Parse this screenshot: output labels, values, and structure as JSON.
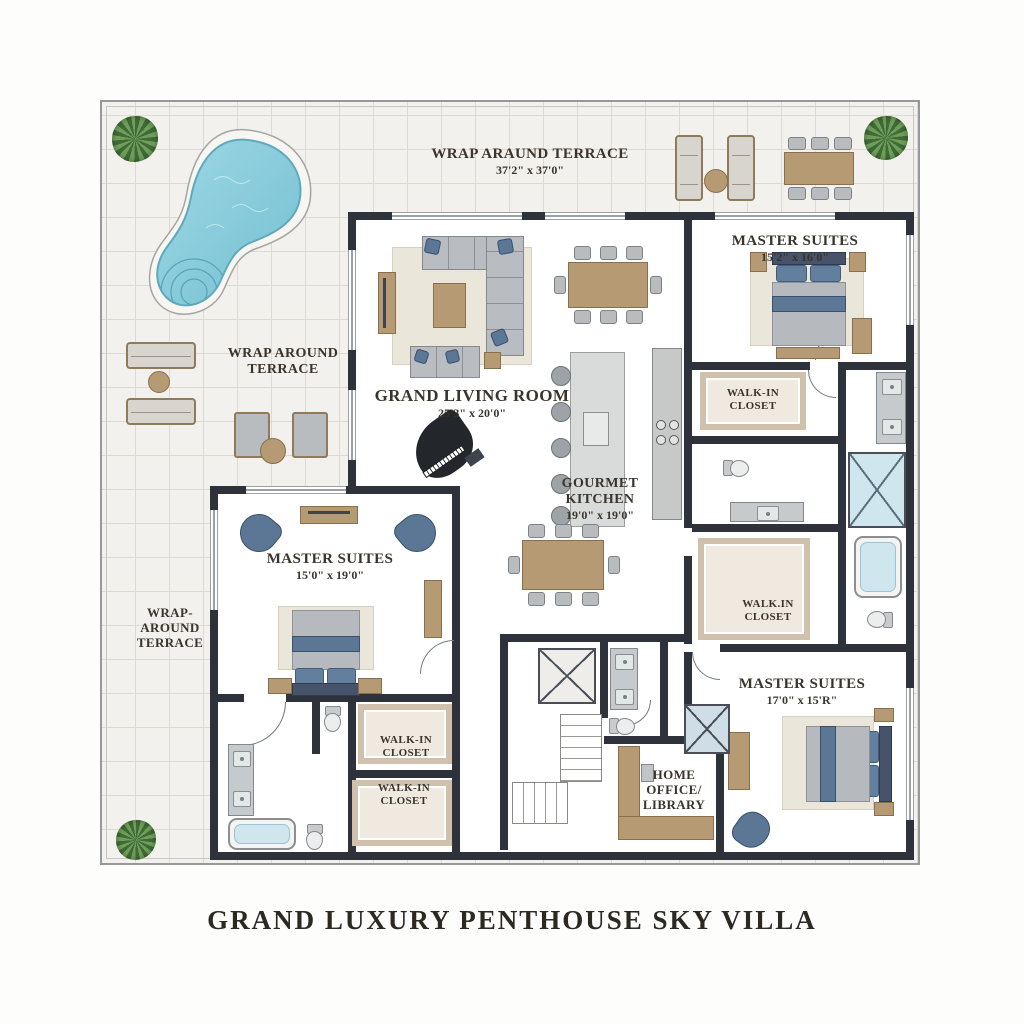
{
  "title": "GRAND LUXURY PENTHOUSE SKY VILLA",
  "colors": {
    "wall": "#2d323b",
    "tile": "#f2f1ed",
    "tile_line": "#dedad3",
    "wood": "#b69a74",
    "accent": "#5b7795",
    "bath": "#cfe6ef",
    "carpet": "#cfc1ac",
    "pool_water": "#8bcedd",
    "pool_edge": "#5fa9bc",
    "label": "#3a342b"
  },
  "labels": {
    "terrace_top": {
      "name": "WRAP ARAUND TERRACE",
      "dims": "37'2\" x 37'0\""
    },
    "terrace_left": {
      "line1": "WRAP AROUND",
      "line2": "TERRACE"
    },
    "terrace_side": {
      "line1": "WRAP-",
      "line2": "AROUND",
      "line3": "TERRACE"
    },
    "living": {
      "name": "GRAND LIVING ROOM",
      "dims": "25'3\" x 20'0\""
    },
    "kitchen": {
      "line1": "GOURMET",
      "line2": "KITCHEN",
      "dims": "19'0\" x 19'0\""
    },
    "suite_top_right": {
      "name": "MASTER SUITES",
      "dims": "15'2\" x 16'0\""
    },
    "suite_left": {
      "name": "MASTER SUITES",
      "dims": "15'0\" x 19'0\""
    },
    "suite_bottom_right": {
      "name": "MASTER SUITES",
      "dims": "17'0\" x 15'R\""
    },
    "closet_top_right": {
      "line1": "WALK-IN",
      "line2": "CLOSET"
    },
    "closet_mid_right": {
      "line1": "WALK.IN",
      "line2": "CLOSET"
    },
    "closet_left_upper": {
      "line1": "WALK-IN",
      "line2": "CLOSET"
    },
    "closet_left_lower": {
      "line1": "WALK-IN",
      "line2": "CLOSET"
    },
    "office": {
      "line1": "HOME",
      "line2": "OFFICE/",
      "line3": "LIBRARY"
    }
  }
}
